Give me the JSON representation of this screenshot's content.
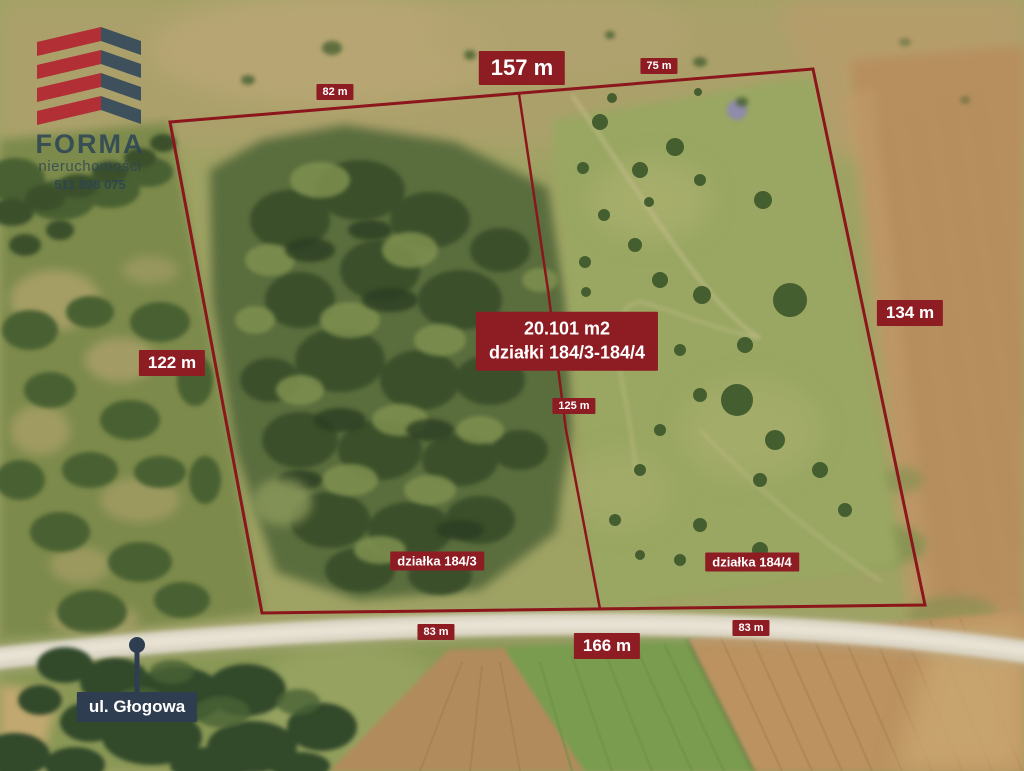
{
  "logo": {
    "brand": "FORMA",
    "subtitle": "nieruchomości",
    "phone": "511 898 075"
  },
  "parcel": {
    "area": "20.101 m2",
    "plots": "działki 184/3-184/4",
    "plot_left": "działka 184/3",
    "plot_right": "działka 184/4"
  },
  "street": "ul. Głogowa",
  "measurements": {
    "top_left": "82 m",
    "top": "157 m",
    "top_right": "75 m",
    "left": "122 m",
    "right": "134 m",
    "middle": "125 m",
    "bottom_left": "83 m",
    "bottom": "166 m",
    "bottom_right": "83 m"
  },
  "colors": {
    "label_red": "#8e1c23",
    "boundary_red": "#8b161c",
    "navy": "#2e3d4f",
    "logo_red": "#b12531",
    "logo_navy": "#33495c"
  }
}
